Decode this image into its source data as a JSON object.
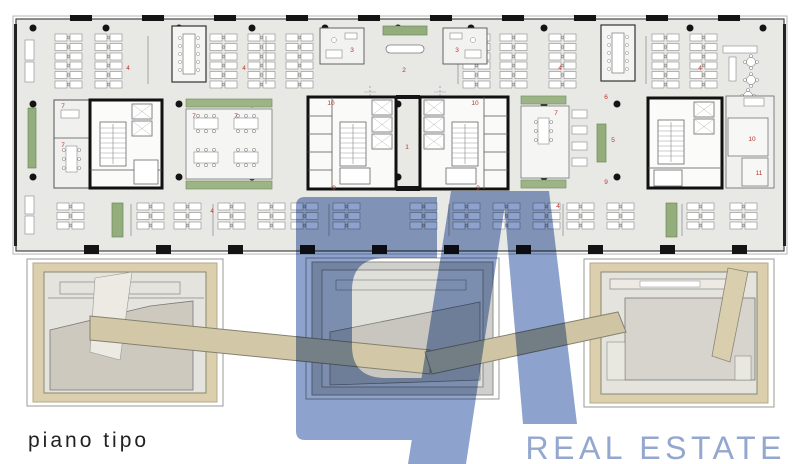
{
  "caption": {
    "text": "piano tipo"
  },
  "logo": {
    "letters": "CA",
    "wordmark": "REAL ESTATE",
    "fill": "#8da2cc",
    "wordmark_color": "#94a7cf"
  },
  "floorplan": {
    "label_color": "#b8352b",
    "room_labels": [
      {
        "n": "1",
        "x": 407,
        "y": 149
      },
      {
        "n": "2",
        "x": 404,
        "y": 72
      },
      {
        "n": "3",
        "x": 352,
        "y": 52
      },
      {
        "n": "3",
        "x": 457,
        "y": 52
      },
      {
        "n": "4",
        "x": 128,
        "y": 70
      },
      {
        "n": "4",
        "x": 244,
        "y": 70
      },
      {
        "n": "4",
        "x": 560,
        "y": 70
      },
      {
        "n": "4",
        "x": 700,
        "y": 70
      },
      {
        "n": "4",
        "x": 212,
        "y": 213
      },
      {
        "n": "4",
        "x": 558,
        "y": 208
      },
      {
        "n": "5",
        "x": 613,
        "y": 142
      },
      {
        "n": "6",
        "x": 606,
        "y": 99
      },
      {
        "n": "7",
        "x": 63,
        "y": 108
      },
      {
        "n": "7",
        "x": 63,
        "y": 147
      },
      {
        "n": "7",
        "x": 194,
        "y": 118
      },
      {
        "n": "7",
        "x": 236,
        "y": 118
      },
      {
        "n": "7",
        "x": 556,
        "y": 115
      },
      {
        "n": "9",
        "x": 334,
        "y": 190
      },
      {
        "n": "9",
        "x": 478,
        "y": 190
      },
      {
        "n": "9",
        "x": 606,
        "y": 184
      },
      {
        "n": "10",
        "x": 331,
        "y": 105
      },
      {
        "n": "10",
        "x": 475,
        "y": 105
      },
      {
        "n": "10",
        "x": 752,
        "y": 141
      },
      {
        "n": "11",
        "x": 759,
        "y": 175
      }
    ]
  },
  "colors": {
    "plan_floor": "#e8e8e5",
    "wall_black": "#141414",
    "planter_green": "#94ad7d",
    "meeting_green": "#9db486",
    "courtyard_beige": "#dbcfae",
    "ramp_beige": "#d2c8a8",
    "logo_blue": "#8da2cc",
    "label_red": "#b8352b"
  }
}
